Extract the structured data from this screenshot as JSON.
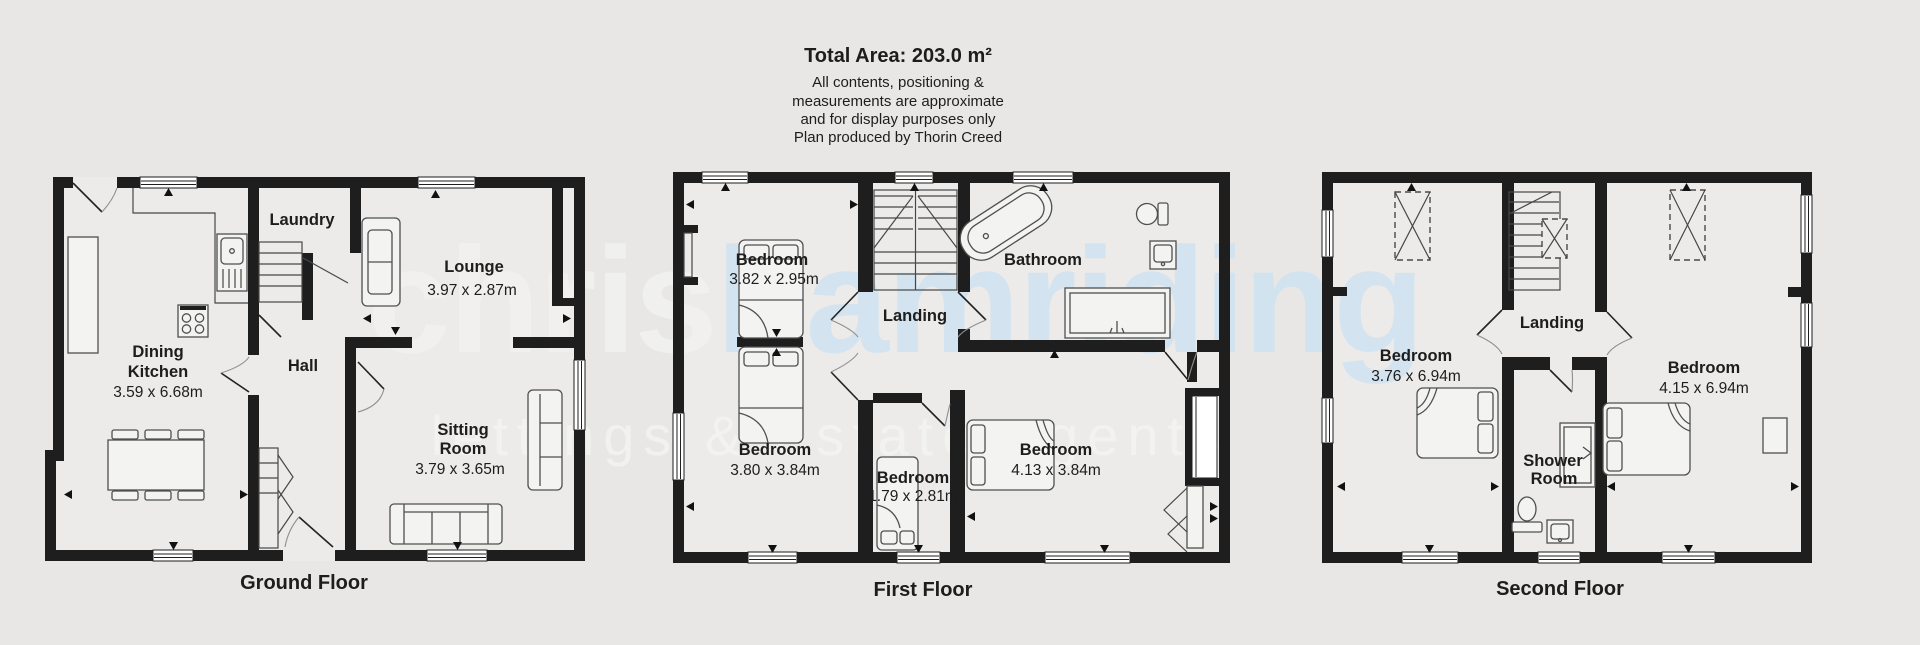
{
  "header": {
    "total_area": "Total Area: 203.0 m²",
    "line1": "All contents, positioning &",
    "line2": "measurements are approximate",
    "line3": "and for display purposes only",
    "line4": "Plan produced by Thorin Creed"
  },
  "watermark": {
    "brand_first": "chris",
    "brand_rest": "hamriding",
    "tagline": "lettings & estate agents",
    "brand_color": "#cfe3f2"
  },
  "floors": {
    "ground": {
      "label": "Ground Floor",
      "laundry": "Laundry",
      "lounge": "Lounge",
      "lounge_dims": "3.97 x 2.87m",
      "dining_line1": "Dining",
      "dining_line2": "Kitchen",
      "dining_dims": "3.59 x 6.68m",
      "hall": "Hall",
      "sitting_line1": "Sitting",
      "sitting_line2": "Room",
      "sitting_dims": "3.79 x 3.65m"
    },
    "first": {
      "label": "First Floor",
      "bedroom1": "Bedroom",
      "bedroom1_dims": "3.82 x 2.95m",
      "landing": "Landing",
      "bathroom": "Bathroom",
      "bedroom2": "Bedroom",
      "bedroom2_dims": "3.80 x 3.84m",
      "bedroom3": "Bedroom",
      "bedroom3_dims": "1.79 x 2.81m",
      "bedroom4": "Bedroom",
      "bedroom4_dims": "4.13 x 3.84m"
    },
    "second": {
      "label": "Second Floor",
      "bedroom1": "Bedroom",
      "bedroom1_dims": "3.76 x 6.94m",
      "landing": "Landing",
      "shower_line1": "Shower",
      "shower_line2": "Room",
      "bedroom2": "Bedroom",
      "bedroom2_dims": "4.15 x 6.94m"
    }
  },
  "colors": {
    "wall": "#1e1e1e",
    "background": "#e8e7e5",
    "watermark_blue": "#cfe3f2"
  }
}
